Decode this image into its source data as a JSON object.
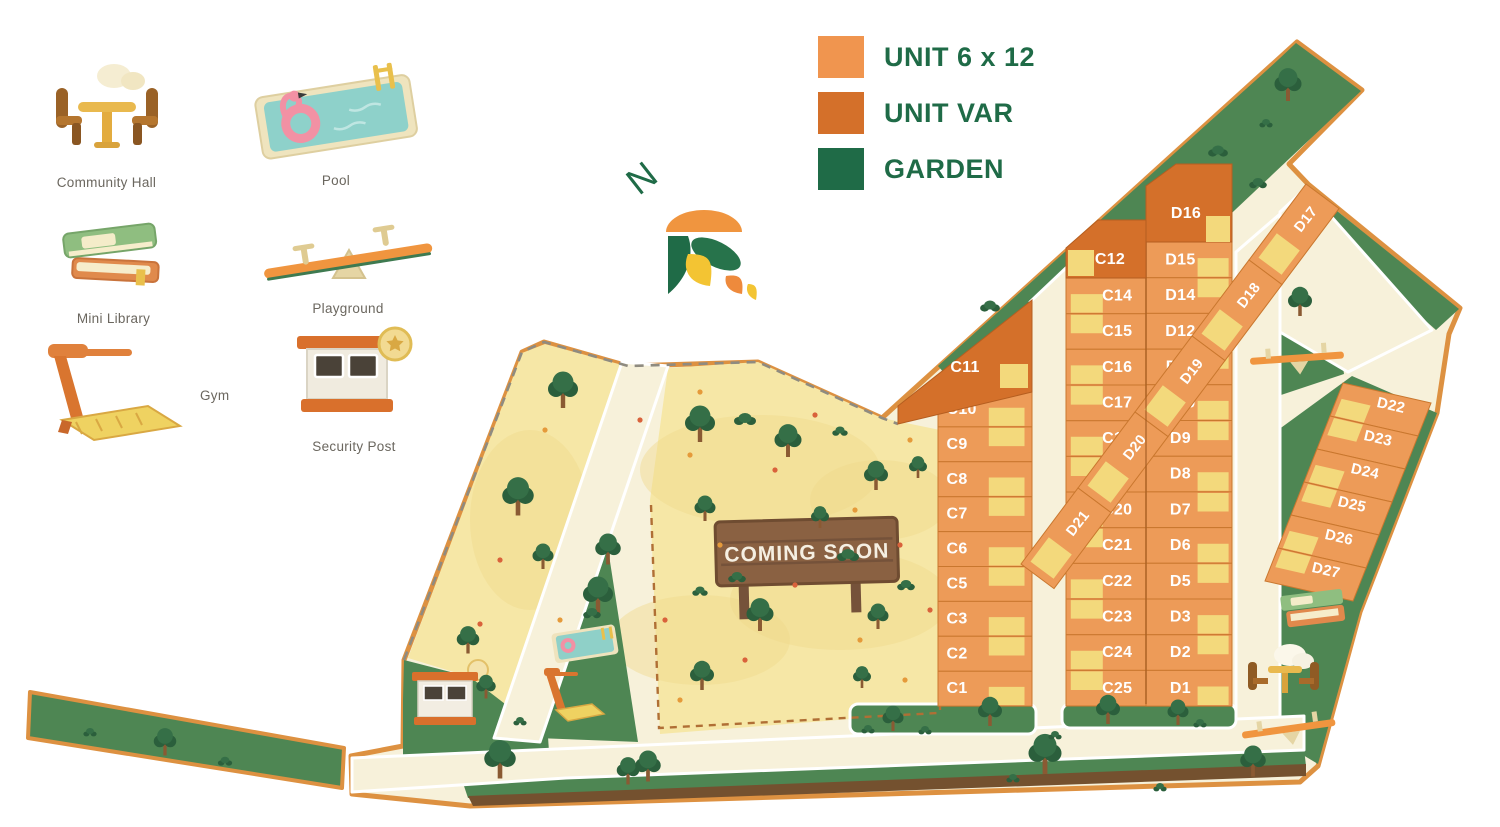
{
  "legend": {
    "items": [
      {
        "label": "UNIT 6 x 12",
        "color": "#F0954F"
      },
      {
        "label": "UNIT VAR",
        "color": "#D4702A"
      },
      {
        "label": "GARDEN",
        "color": "#1F6B47"
      }
    ]
  },
  "north": {
    "label": "N"
  },
  "amenities": [
    {
      "label": "Community Hall"
    },
    {
      "label": "Pool"
    },
    {
      "label": "Mini Library"
    },
    {
      "label": "Playground"
    },
    {
      "label": "Gym"
    },
    {
      "label": "Security Post"
    }
  ],
  "map": {
    "coming_soon_label": "COMING SOON",
    "units": {
      "row_c_left": [
        "C10",
        "C9",
        "C8",
        "C7",
        "C6",
        "C5",
        "C3",
        "C2",
        "C1"
      ],
      "row_c_mid": [
        "C14",
        "C15",
        "C16",
        "C17",
        "C18",
        "C19",
        "C20",
        "C21",
        "C22",
        "C23",
        "C24",
        "C25"
      ],
      "row_d_main": [
        "D15",
        "D14",
        "D12",
        "D11",
        "D10",
        "D9",
        "D8",
        "D7",
        "D6",
        "D5",
        "D3",
        "D2",
        "D1"
      ],
      "row_d_top": [
        "D17",
        "D18",
        "D19",
        "D20",
        "D21"
      ],
      "row_d_right": [
        "D22",
        "D23",
        "D24",
        "D25",
        "D26",
        "D27"
      ],
      "var_units": [
        "C11",
        "C12",
        "D16"
      ]
    },
    "colors": {
      "unit_standard": "#ED9B58",
      "unit_var": "#D4702A",
      "yard": "#F3D97C",
      "garden": "#4E8653",
      "land": "#F7F1DA",
      "yellow_area": "#F6E7A6",
      "border": "#DD9141",
      "sign": "#8A6142"
    }
  }
}
